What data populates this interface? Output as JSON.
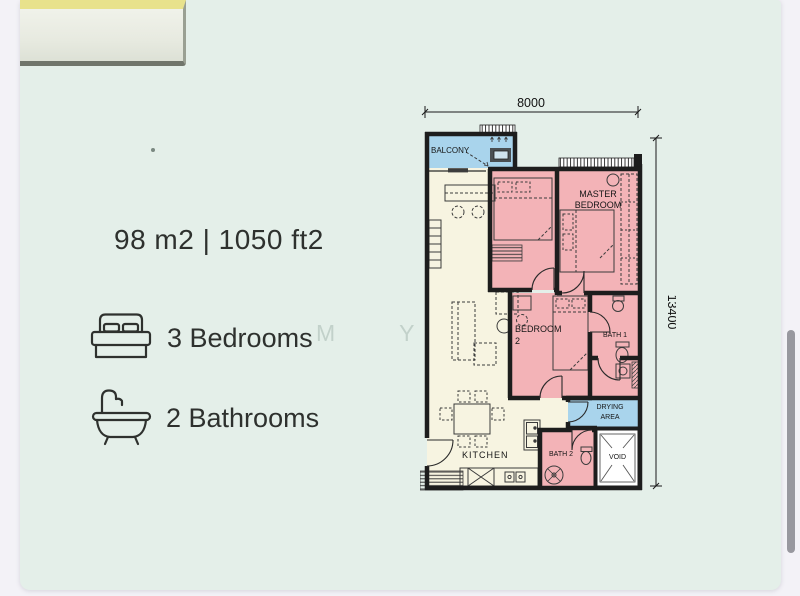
{
  "window": {
    "background": "#f3f2f7",
    "card_background": "#e4efe9",
    "scrollbar_color": "#98989f"
  },
  "header_tab": {
    "accent_color": "#e8e28c"
  },
  "summary": {
    "area": "98 m2 | 1050 ft2",
    "bedrooms_label": "3 Bedrooms",
    "bathrooms_label": "2 Bathrooms"
  },
  "watermark": "M Y Y C",
  "floorplan": {
    "dim_width": "8000",
    "dim_height": "13400",
    "labels": {
      "balcony": "BALCONY",
      "master_line1": "MASTER",
      "master_line2": "BEDROOM",
      "bedroom2_line1": "BEDROOM",
      "bedroom2_line2": "2",
      "bath1": "BATH 1",
      "bath2": "BATH 2",
      "drying_line1": "DRYING",
      "drying_line2": "AREA",
      "void": "VOID",
      "kitchen": "KITCHEN"
    },
    "colors": {
      "bedroom_pink": "#f3b3b7",
      "balcony_blue": "#a9d4ec",
      "living_cream": "#f7f4e1",
      "wall": "#1d1d1d",
      "void_white": "#ffffff"
    }
  }
}
